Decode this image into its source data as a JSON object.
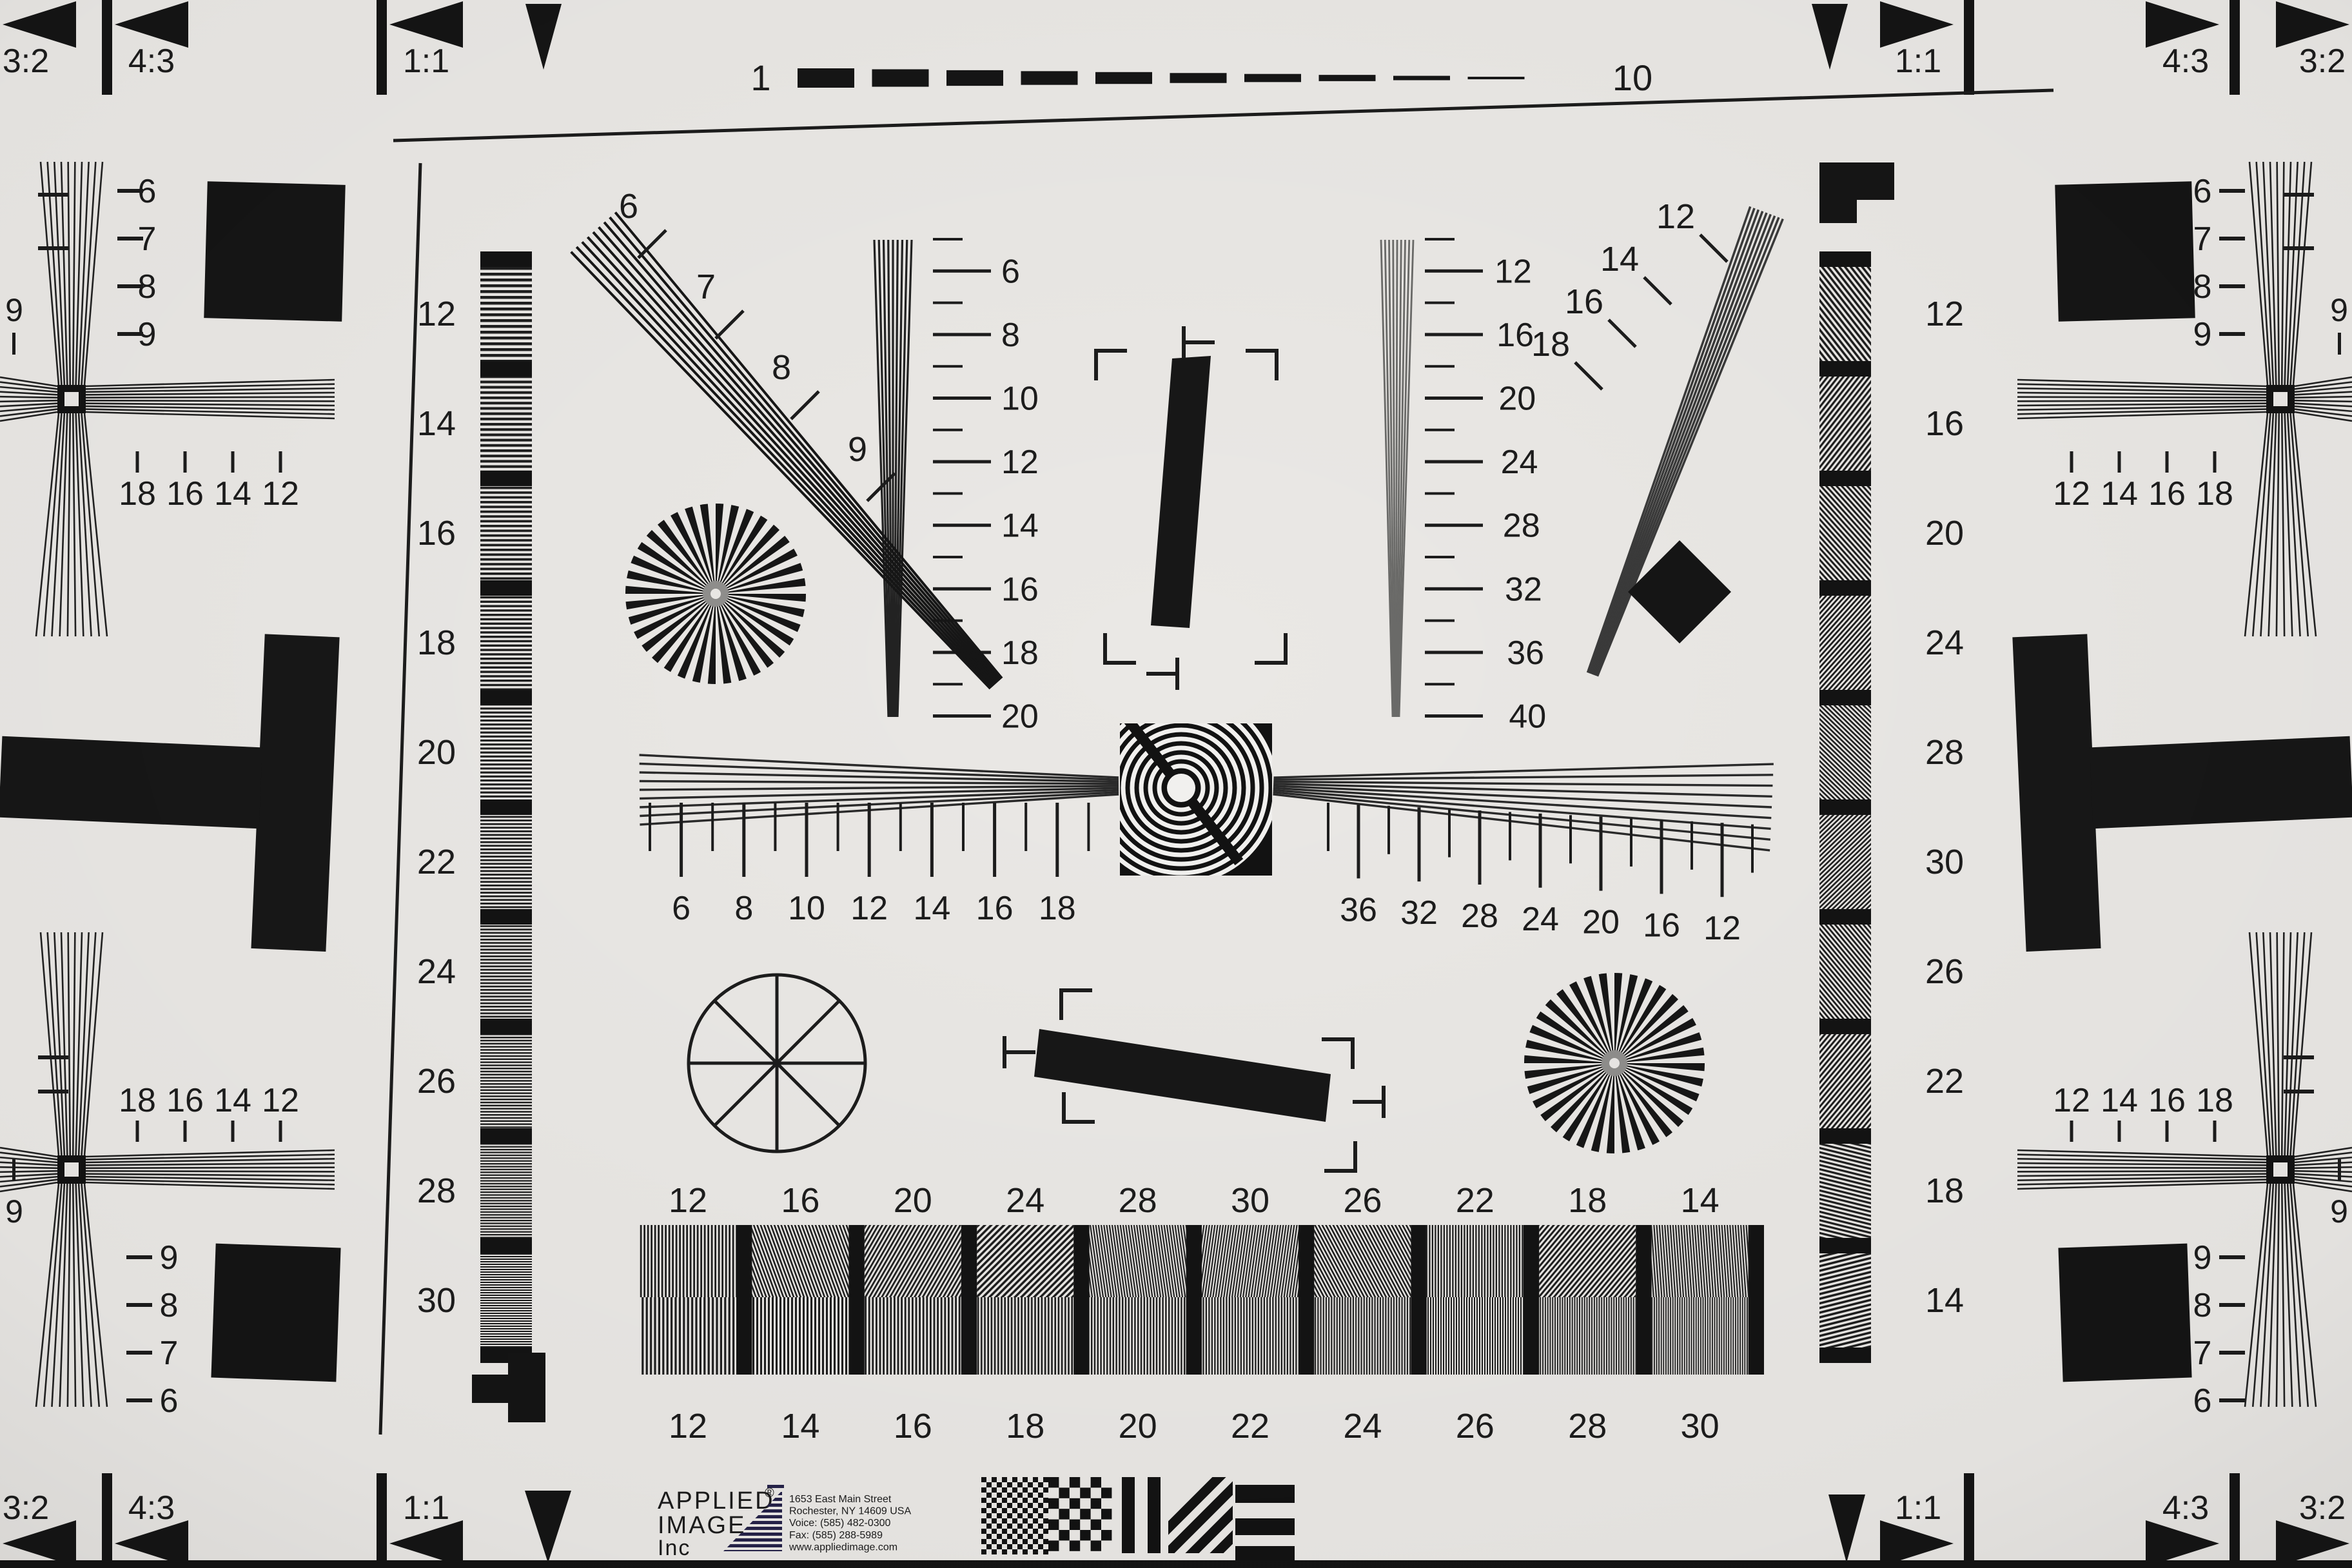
{
  "corner_markers": {
    "top_left": {
      "labels": [
        "3:2",
        "4:3",
        "1:1"
      ]
    },
    "top_right": {
      "labels": [
        "1:1",
        "4:3",
        "3:2"
      ]
    },
    "bottom_left": {
      "labels": [
        "3:2",
        "4:3",
        "1:1"
      ]
    },
    "bottom_right": {
      "labels": [
        "1:1",
        "4:3",
        "3:2"
      ]
    }
  },
  "top_ruler": {
    "start": "1",
    "end": "10",
    "dash_count": 10
  },
  "vertical_strips": {
    "left_labels": [
      "12",
      "14",
      "16",
      "18",
      "20",
      "22",
      "24",
      "26",
      "28",
      "30"
    ],
    "right_labels": [
      "12",
      "16",
      "20",
      "24",
      "28",
      "30",
      "26",
      "22",
      "18",
      "14"
    ]
  },
  "wedge_labels": {
    "upper_left_diagonal": [
      "6",
      "7",
      "8",
      "9"
    ],
    "upper_right_diagonal": [
      "12",
      "14",
      "16",
      "18"
    ],
    "left_vertical": [
      "6",
      "8",
      "10",
      "12",
      "14",
      "16",
      "18",
      "20"
    ],
    "right_vertical": [
      "12",
      "16",
      "20",
      "24",
      "28",
      "32",
      "36",
      "40"
    ],
    "center_left": [
      "6",
      "8",
      "10",
      "12",
      "14",
      "16",
      "18"
    ],
    "center_right": [
      "36",
      "32",
      "28",
      "24",
      "20",
      "16",
      "12"
    ]
  },
  "corner_fans": {
    "top_left": {
      "column": [
        "6",
        "7",
        "8",
        "9"
      ],
      "row": [
        "18",
        "16",
        "14",
        "12"
      ],
      "edge": "9"
    },
    "top_right": {
      "column": [
        "6",
        "7",
        "8",
        "9"
      ],
      "row": [
        "12",
        "14",
        "16",
        "18"
      ],
      "edge": "9"
    },
    "bottom_left": {
      "column": [
        "9",
        "8",
        "7",
        "6"
      ],
      "row": [
        "18",
        "16",
        "14",
        "12"
      ],
      "edge": "9"
    },
    "bottom_right": {
      "column": [
        "9",
        "8",
        "7",
        "6"
      ],
      "row": [
        "12",
        "14",
        "16",
        "18"
      ],
      "edge": "9"
    }
  },
  "bottom_bars": {
    "top_labels": [
      "12",
      "16",
      "20",
      "24",
      "28",
      "30",
      "26",
      "22",
      "18",
      "14"
    ],
    "bottom_labels": [
      "12",
      "14",
      "16",
      "18",
      "20",
      "22",
      "24",
      "26",
      "28",
      "30"
    ]
  },
  "logo": {
    "name_line1": "APPLIED",
    "registered": "®",
    "name_line2": "IMAGE",
    "name_line3": "Inc",
    "address_lines": [
      "1653 East Main Street",
      "Rochester, NY  14609  USA",
      "Voice:   (585) 482-0300",
      "Fax:      (585) 288-5989",
      "www.appliedimage.com"
    ]
  },
  "colors": {
    "paper": "#eae8e5",
    "ink": "#1c1c1c",
    "logo_navy": "#262349",
    "address_gray": "#3c3c48"
  }
}
